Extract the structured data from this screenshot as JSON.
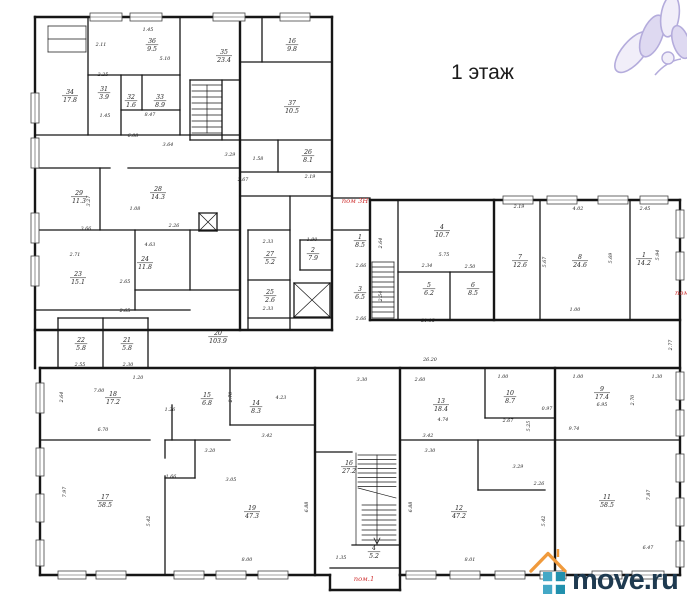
{
  "title": "1 этаж",
  "watermark": {
    "logo_text": "move.ru",
    "roof_color": "#f09a3c",
    "square_color": "#2190ad",
    "square_color_light": "#44a8c6",
    "text_color": "#1e3a50",
    "flower_color": "#a89ed6",
    "flower_fill": "#efecf8"
  },
  "colors": {
    "wall": "#161616",
    "dim_text": "#1c1c1c",
    "red": "#d03434"
  },
  "annotations": {
    "items": [
      {
        "text": "пом 3Н",
        "x": 355,
        "y": 203
      },
      {
        "text": "пом.1",
        "x": 364,
        "y": 581
      },
      {
        "text": "пом",
        "x": 682,
        "y": 295
      }
    ]
  },
  "floor_plan": {
    "rooms": [
      {
        "n": "36",
        "a": "9.5",
        "x": 152,
        "y": 44
      },
      {
        "n": "35",
        "a": "23.4",
        "x": 224,
        "y": 55
      },
      {
        "n": "16",
        "a": "9.8",
        "x": 292,
        "y": 44
      },
      {
        "n": "34",
        "a": "17.8",
        "x": 70,
        "y": 95
      },
      {
        "n": "31",
        "a": "3.9",
        "x": 104,
        "y": 92
      },
      {
        "n": "32",
        "a": "1.6",
        "x": 131,
        "y": 100
      },
      {
        "n": "33",
        "a": "8.9",
        "x": 160,
        "y": 100
      },
      {
        "n": "37",
        "a": "10.5",
        "x": 292,
        "y": 106
      },
      {
        "n": "29",
        "a": "11.3",
        "x": 79,
        "y": 196
      },
      {
        "n": "28",
        "a": "14.3",
        "x": 158,
        "y": 192
      },
      {
        "n": "26",
        "a": "8.1",
        "x": 308,
        "y": 155
      },
      {
        "n": "27",
        "a": "5.2",
        "x": 270,
        "y": 257
      },
      {
        "n": "2",
        "a": "7.9",
        "x": 313,
        "y": 253
      },
      {
        "n": "25",
        "a": "2.6",
        "x": 270,
        "y": 295
      },
      {
        "n": "23",
        "a": "15.1",
        "x": 78,
        "y": 277
      },
      {
        "n": "24",
        "a": "11.8",
        "x": 145,
        "y": 262
      },
      {
        "n": "22",
        "a": "5.8",
        "x": 81,
        "y": 343
      },
      {
        "n": "21",
        "a": "5.8",
        "x": 127,
        "y": 343
      },
      {
        "n": "20",
        "a": "103.9",
        "x": 218,
        "y": 336
      },
      {
        "n": "1",
        "a": "8.5",
        "x": 360,
        "y": 240
      },
      {
        "n": "3",
        "a": "6.5",
        "x": 360,
        "y": 292
      },
      {
        "n": "4",
        "a": "10.7",
        "x": 442,
        "y": 230
      },
      {
        "n": "5",
        "a": "6.2",
        "x": 429,
        "y": 288
      },
      {
        "n": "6",
        "a": "8.5",
        "x": 473,
        "y": 288
      },
      {
        "n": "7",
        "a": "12.6",
        "x": 520,
        "y": 260
      },
      {
        "n": "8",
        "a": "24.6",
        "x": 580,
        "y": 260
      },
      {
        "n": "1",
        "a": "14.2",
        "x": 644,
        "y": 258
      },
      {
        "n": "18",
        "a": "17.2",
        "x": 113,
        "y": 397
      },
      {
        "n": "15",
        "a": "6.8",
        "x": 207,
        "y": 398
      },
      {
        "n": "14",
        "a": "8.3",
        "x": 256,
        "y": 406
      },
      {
        "n": "16",
        "a": "27.2",
        "x": 349,
        "y": 466
      },
      {
        "n": "13",
        "a": "18.4",
        "x": 441,
        "y": 404
      },
      {
        "n": "10",
        "a": "8.7",
        "x": 510,
        "y": 396
      },
      {
        "n": "9",
        "a": "17.4",
        "x": 602,
        "y": 392
      },
      {
        "n": "17",
        "a": "58.5",
        "x": 105,
        "y": 500
      },
      {
        "n": "19",
        "a": "47.3",
        "x": 252,
        "y": 511
      },
      {
        "n": "12",
        "a": "47.2",
        "x": 459,
        "y": 511
      },
      {
        "n": "11",
        "a": "58.5",
        "x": 607,
        "y": 500
      },
      {
        "n": "4",
        "a": "5.2",
        "x": 374,
        "y": 551
      }
    ],
    "dims": [
      {
        "t": "1.45",
        "x": 148,
        "y": 31
      },
      {
        "t": "2.11",
        "x": 101,
        "y": 46
      },
      {
        "t": "5.10",
        "x": 165,
        "y": 60
      },
      {
        "t": "2.25",
        "x": 103,
        "y": 76
      },
      {
        "t": "1.45",
        "x": 105,
        "y": 117
      },
      {
        "t": "8.47",
        "x": 150,
        "y": 116
      },
      {
        "t": "6.08",
        "x": 133,
        "y": 137
      },
      {
        "t": "3.64",
        "x": 168,
        "y": 146
      },
      {
        "t": "3.29",
        "x": 230,
        "y": 156
      },
      {
        "t": "1.58",
        "x": 258,
        "y": 160
      },
      {
        "t": "2.67",
        "x": 243,
        "y": 181
      },
      {
        "t": "2.19",
        "x": 310,
        "y": 178
      },
      {
        "t": "3.27",
        "x": 90,
        "y": 201,
        "v": 1
      },
      {
        "t": "1.08",
        "x": 135,
        "y": 210
      },
      {
        "t": "2.26",
        "x": 174,
        "y": 227
      },
      {
        "t": "3.66",
        "x": 86,
        "y": 230
      },
      {
        "t": "2.71",
        "x": 75,
        "y": 256
      },
      {
        "t": "4.63",
        "x": 150,
        "y": 246
      },
      {
        "t": "2.65",
        "x": 125,
        "y": 283
      },
      {
        "t": "2.65",
        "x": 125,
        "y": 312
      },
      {
        "t": "2.55",
        "x": 80,
        "y": 366
      },
      {
        "t": "2.30",
        "x": 128,
        "y": 366
      },
      {
        "t": "2.33",
        "x": 268,
        "y": 243
      },
      {
        "t": "1.90",
        "x": 312,
        "y": 241
      },
      {
        "t": "2.33",
        "x": 268,
        "y": 310
      },
      {
        "t": "2.66",
        "x": 361,
        "y": 267
      },
      {
        "t": "2.66",
        "x": 361,
        "y": 320
      },
      {
        "t": "2.64",
        "x": 382,
        "y": 243,
        "v": 1
      },
      {
        "t": "2.54",
        "x": 382,
        "y": 296,
        "v": 1
      },
      {
        "t": "5.75",
        "x": 444,
        "y": 256
      },
      {
        "t": "2.34",
        "x": 427,
        "y": 267
      },
      {
        "t": "2.50",
        "x": 470,
        "y": 268
      },
      {
        "t": "2.19",
        "x": 519,
        "y": 208
      },
      {
        "t": "4.02",
        "x": 578,
        "y": 210
      },
      {
        "t": "2.45",
        "x": 645,
        "y": 210
      },
      {
        "t": "5.67",
        "x": 546,
        "y": 262,
        "v": 1
      },
      {
        "t": "5.69",
        "x": 612,
        "y": 258,
        "v": 1
      },
      {
        "t": "5.94",
        "x": 659,
        "y": 255,
        "v": 1
      },
      {
        "t": "1.00",
        "x": 575,
        "y": 311
      },
      {
        "t": "21.15",
        "x": 428,
        "y": 322
      },
      {
        "t": "2.77",
        "x": 672,
        "y": 345,
        "v": 1
      },
      {
        "t": "26.20",
        "x": 430,
        "y": 361
      },
      {
        "t": "1.20",
        "x": 138,
        "y": 379
      },
      {
        "t": "7.00",
        "x": 99,
        "y": 392
      },
      {
        "t": "2.64",
        "x": 63,
        "y": 397,
        "v": 1
      },
      {
        "t": "1.26",
        "x": 170,
        "y": 411
      },
      {
        "t": "6.70",
        "x": 103,
        "y": 431
      },
      {
        "t": "2.70",
        "x": 232,
        "y": 397,
        "v": 1
      },
      {
        "t": "4.23",
        "x": 281,
        "y": 399
      },
      {
        "t": "3.30",
        "x": 362,
        "y": 381
      },
      {
        "t": "2.60",
        "x": 420,
        "y": 381
      },
      {
        "t": "1.00",
        "x": 503,
        "y": 378
      },
      {
        "t": "1.00",
        "x": 578,
        "y": 378
      },
      {
        "t": "1.30",
        "x": 657,
        "y": 378
      },
      {
        "t": "0.97",
        "x": 547,
        "y": 410
      },
      {
        "t": "2.70",
        "x": 634,
        "y": 400,
        "v": 1
      },
      {
        "t": "6.95",
        "x": 602,
        "y": 406
      },
      {
        "t": "4.74",
        "x": 443,
        "y": 421
      },
      {
        "t": "2.67",
        "x": 508,
        "y": 422
      },
      {
        "t": "9.74",
        "x": 574,
        "y": 430
      },
      {
        "t": "5.25",
        "x": 530,
        "y": 426,
        "v": 1
      },
      {
        "t": "3.42",
        "x": 267,
        "y": 437
      },
      {
        "t": "3.42",
        "x": 428,
        "y": 437
      },
      {
        "t": "3.20",
        "x": 210,
        "y": 452
      },
      {
        "t": "3.30",
        "x": 430,
        "y": 452
      },
      {
        "t": "1.66",
        "x": 171,
        "y": 478
      },
      {
        "t": "3.05",
        "x": 231,
        "y": 481
      },
      {
        "t": "3.29",
        "x": 518,
        "y": 468
      },
      {
        "t": "2.26",
        "x": 539,
        "y": 485
      },
      {
        "t": "7.97",
        "x": 66,
        "y": 492,
        "v": 1
      },
      {
        "t": "7.87",
        "x": 650,
        "y": 495,
        "v": 1
      },
      {
        "t": "5.42",
        "x": 150,
        "y": 521,
        "v": 1
      },
      {
        "t": "5.42",
        "x": 545,
        "y": 521,
        "v": 1
      },
      {
        "t": "6.88",
        "x": 308,
        "y": 507,
        "v": 1
      },
      {
        "t": "6.88",
        "x": 412,
        "y": 507,
        "v": 1
      },
      {
        "t": "1.35",
        "x": 341,
        "y": 559
      },
      {
        "t": "8.00",
        "x": 247,
        "y": 561
      },
      {
        "t": "8.01",
        "x": 470,
        "y": 561
      },
      {
        "t": "6.47",
        "x": 648,
        "y": 549
      }
    ]
  }
}
